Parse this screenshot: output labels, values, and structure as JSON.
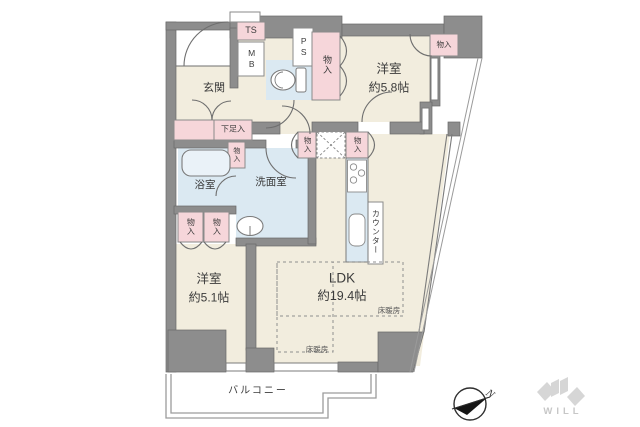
{
  "rooms": {
    "genkan": {
      "label": "玄関"
    },
    "bedroom1": {
      "label": "洋室",
      "size": "約5.8帖"
    },
    "bedroom2": {
      "label": "洋室",
      "size": "約5.1帖"
    },
    "ldk": {
      "label": "LDK",
      "size": "約19.4帖"
    },
    "bathroom": {
      "label": "浴室"
    },
    "washroom": {
      "label": "洗面室"
    },
    "balcony": {
      "label": "バルコニー"
    }
  },
  "storage": {
    "closet": "物入",
    "shoe_box": "下足入",
    "trunk_space": "TS",
    "meter_box": "MB",
    "pipe_space": "PS",
    "counter": "カウンター"
  },
  "annotations": {
    "floor_heating": "床暖房",
    "compass_north": "N",
    "brand": "WILL"
  },
  "colors": {
    "wall": "#8d8d8d",
    "room_floor": "#f2edde",
    "wet_area": "#dbe9f2",
    "storage_pink": "#f6d6da",
    "line": "#6f6f6f",
    "logo_gray": "#d6d6d6"
  }
}
